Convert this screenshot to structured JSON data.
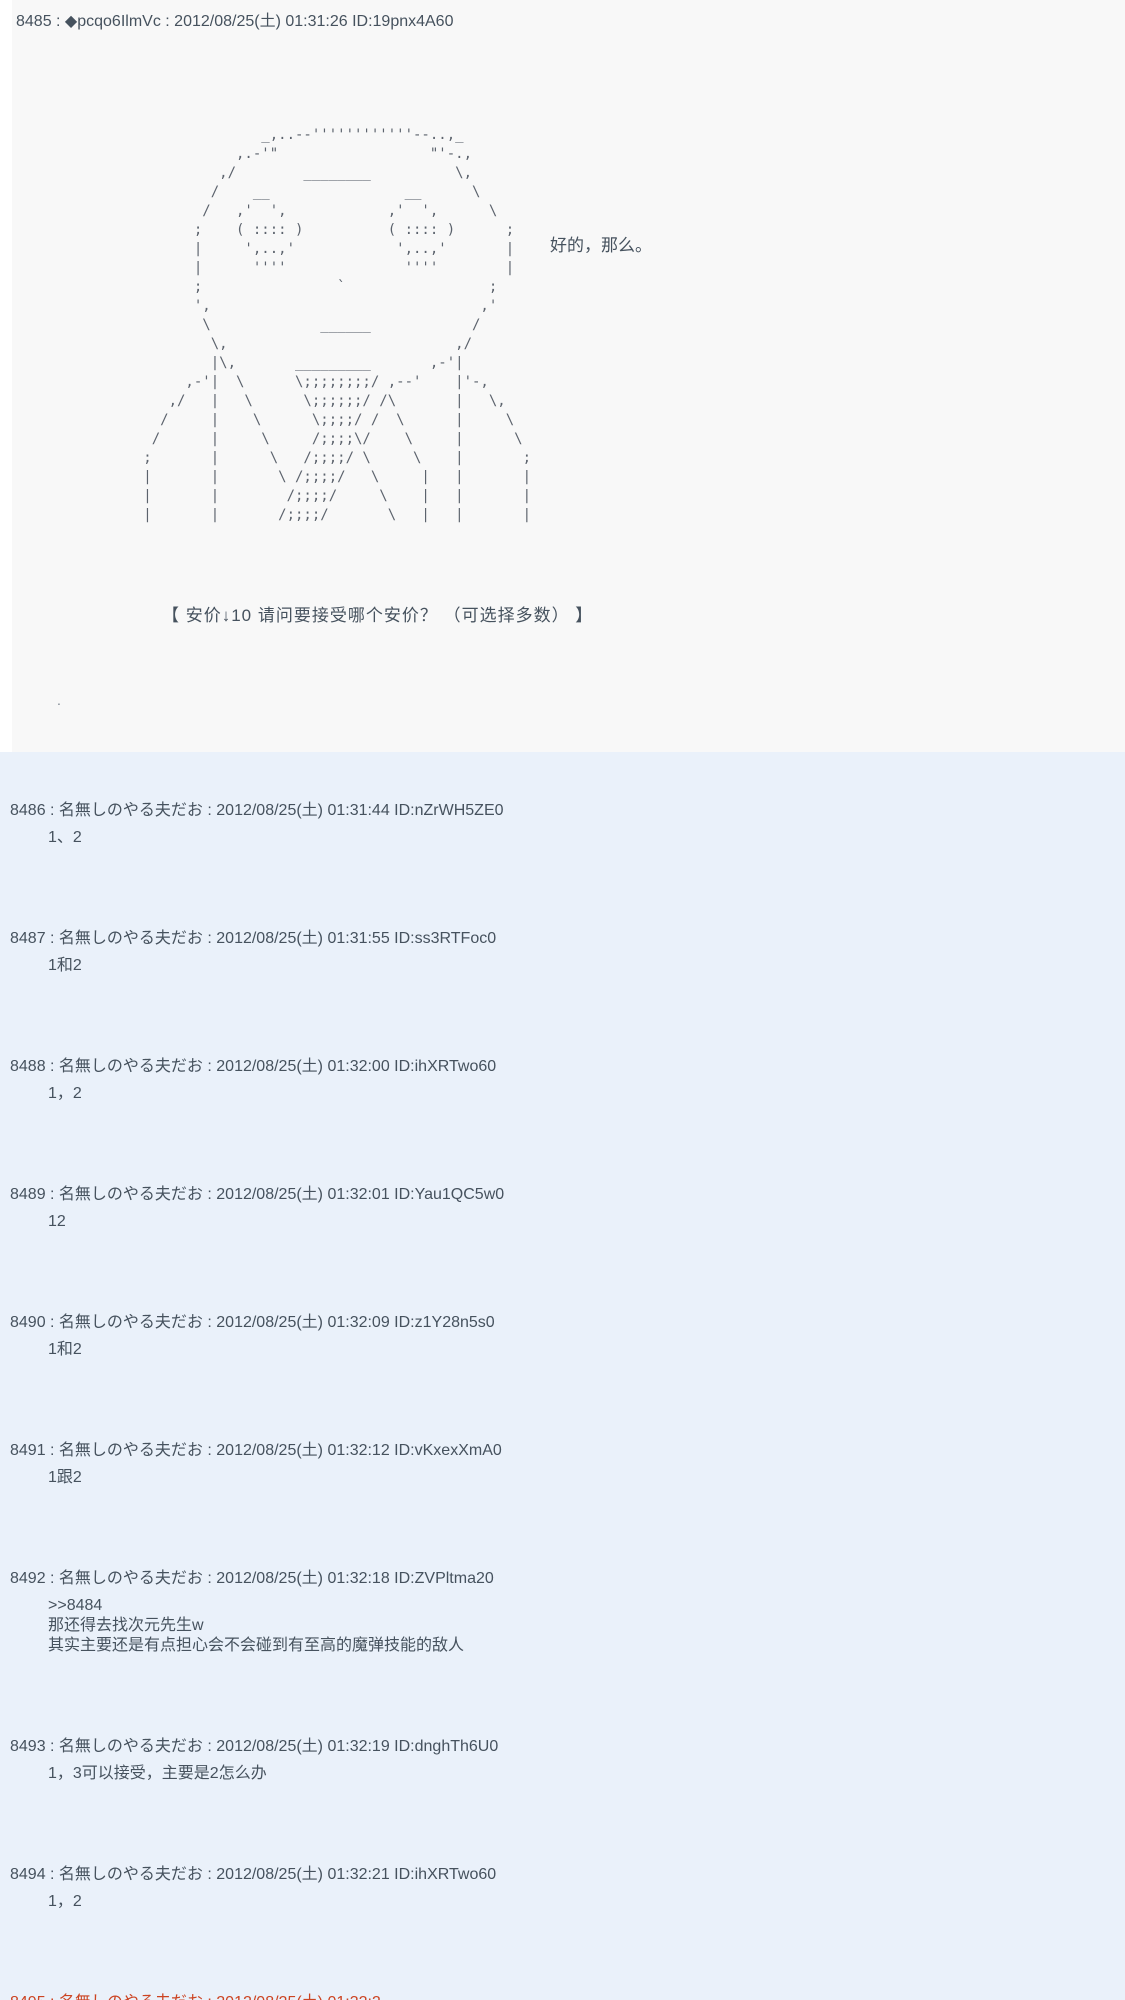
{
  "page": {
    "bg_top": "#f8f8f8",
    "bg_thread": "#eaf1fa",
    "text_color": "#46525e",
    "aa_color": "#5c636d",
    "clipped_header_color": "#cc4422"
  },
  "top_post": {
    "header": "8485 : ◆pcqo6IlmVc : 2012/08/25(土) 01:31:26 ID:19pnx4A60",
    "aa_art": [
      "                 _,..--''''''''''''--..,_",
      "              ,.-'\"                  \"'-.,",
      "            ,/        ________          \\,",
      "           /    __                __      \\",
      "          /   ,'  ',            ,'  ',      \\",
      "         ;    ( :::: )          ( :::: )      ;",
      "         |     ',..,'            ',..,'       |",
      "         |      ''''              ''''        |",
      "         ;                `                 ;",
      "         ',                                ,'",
      "          \\             ______            /",
      "           \\,                           ,/",
      "           |\\,       _________       ,-'|",
      "        ,-'|  \\      \\;;;;;;;;/ ,--'    |'-,",
      "      ,/   |   \\      \\;;;;;;/ /\\       |   \\,",
      "     /     |    \\      \\;;;;/ /  \\      |     \\",
      "    /      |     \\     /;;;;\\/    \\     |      \\",
      "   ;       |      \\   /;;;;/ \\     \\    |       ;",
      "   |       |       \\ /;;;;/   \\     |   |       |",
      "   |       |        /;;;;/     \\    |   |       |",
      "   |       |       /;;;;/       \\   |   |       |"
    ],
    "dialogue": "好的，那么。",
    "anchor_prompt": "【 安价↓10  请问要接受哪个安价？ （可选择多数） 】",
    "stray_mark": "."
  },
  "posts": [
    {
      "header": "8486 : 名無しのやる夫だお : 2012/08/25(土) 01:31:44 ID:nZrWH5ZE0",
      "body": [
        "1、2"
      ]
    },
    {
      "header": "8487 : 名無しのやる夫だお : 2012/08/25(土) 01:31:55 ID:ss3RTFoc0",
      "body": [
        "1和2"
      ]
    },
    {
      "header": "8488 : 名無しのやる夫だお : 2012/08/25(土) 01:32:00 ID:ihXRTwo60",
      "body": [
        "1，2"
      ]
    },
    {
      "header": "8489 : 名無しのやる夫だお : 2012/08/25(土) 01:32:01 ID:Yau1QC5w0",
      "body": [
        "12"
      ]
    },
    {
      "header": "8490 : 名無しのやる夫だお : 2012/08/25(土) 01:32:09 ID:z1Y28n5s0",
      "body": [
        "1和2"
      ]
    },
    {
      "header": "8491 : 名無しのやる夫だお : 2012/08/25(土) 01:32:12 ID:vKxexXmA0",
      "body": [
        "1跟2"
      ]
    },
    {
      "header": "8492 : 名無しのやる夫だお : 2012/08/25(土) 01:32:18 ID:ZVPltma20",
      "body": [
        ">>8484",
        "那还得去找次元先生w",
        "其实主要还是有点担心会不会碰到有至高的魔弹技能的敌人"
      ]
    },
    {
      "header": "8493 : 名無しのやる夫だお : 2012/08/25(土) 01:32:19 ID:dnghTh6U0",
      "body": [
        "1，3可以接受，主要是2怎么办"
      ]
    },
    {
      "header": "8494 : 名無しのやる夫だお : 2012/08/25(土) 01:32:21 ID:ihXRTwo60",
      "body": [
        "1，2"
      ]
    }
  ],
  "clipped_post": {
    "header": "8495 : 名無しのやる夫だお : 2012/08/25(土) 01:32:2"
  }
}
